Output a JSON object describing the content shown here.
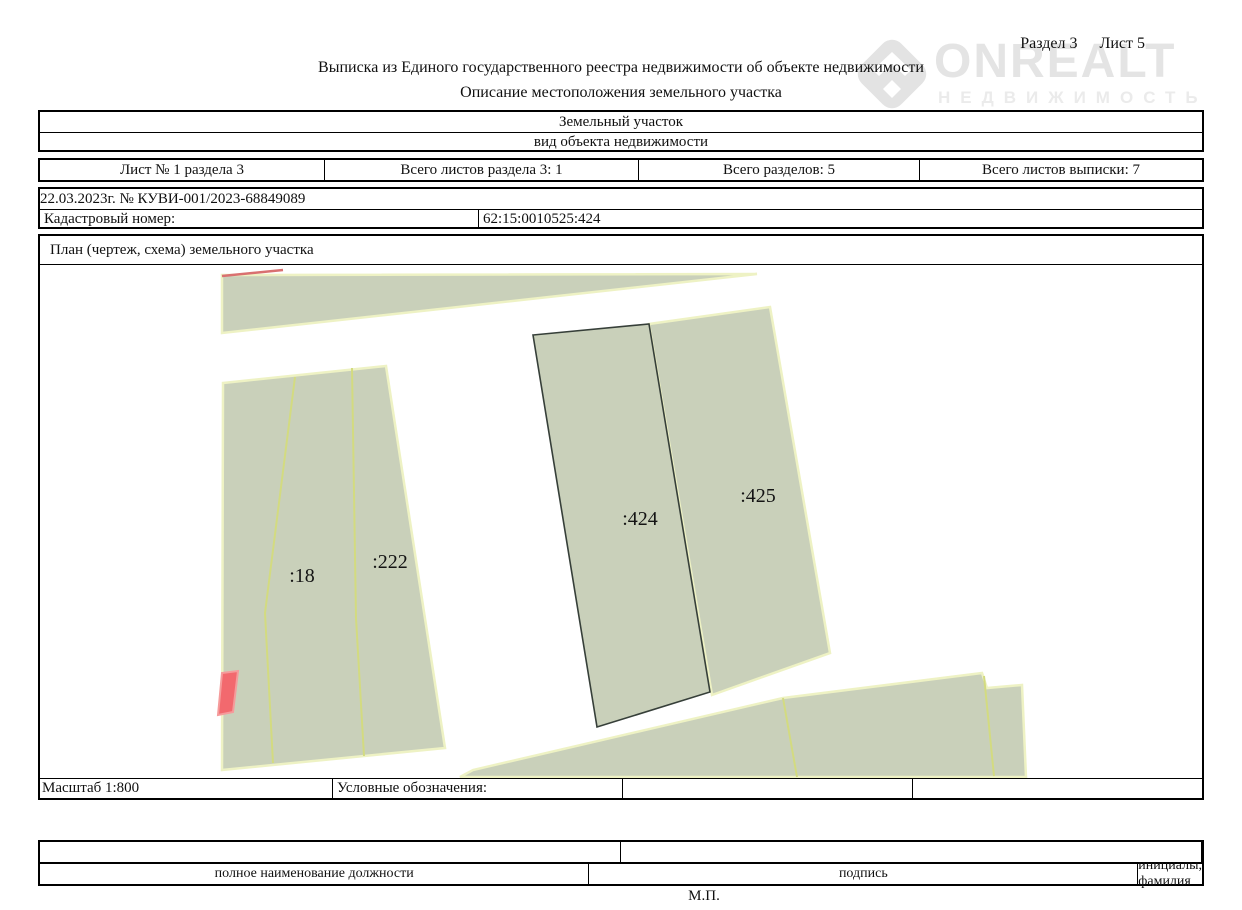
{
  "page_header": {
    "section": "Раздел 3",
    "sheet": "Лист 5"
  },
  "watermark": {
    "brand": "ONREALT",
    "sub": "НЕДВИЖИМОСТЬ"
  },
  "title": "Выписка из Единого государственного реестра недвижимости об объекте недвижимости",
  "subtitle": "Описание местоположения земельного участка",
  "object_table": {
    "value": "Земельный участок",
    "caption": "вид объекта недвижимости"
  },
  "sheets_table": {
    "cells": [
      "Лист № 1 раздела 3",
      "Всего листов раздела 3: 1",
      "Всего разделов: 5",
      "Всего листов выписки: 7"
    ]
  },
  "doc_info": {
    "date_number": "22.03.2023г. № КУВИ-001/2023-68849089",
    "cadastral_label": "Кадастровый номер:",
    "cadastral_value": "62:15:0010525:424"
  },
  "plan": {
    "header": "План (чертеж, схема) земельного участка",
    "scale_label": "Масштаб 1:800",
    "legend_label": "Условные обозначения:",
    "parcels": [
      {
        "label": ":18"
      },
      {
        "label": ":222"
      },
      {
        "label": ":424"
      },
      {
        "label": ":425"
      }
    ],
    "colors": {
      "parcel_fill": "#c9d0ba",
      "parcel_edge": "#eef2c4",
      "boundary_line": "#d3db80",
      "subject_outline": "#363f39",
      "building_fill": "#f2696e",
      "building_edge": "#f59b9b",
      "red_boundary": "#d97070"
    }
  },
  "signature_table": {
    "columns": [
      "полное наименование должности",
      "подпись",
      "инициалы, фамилия"
    ],
    "stamp": "М.П."
  }
}
